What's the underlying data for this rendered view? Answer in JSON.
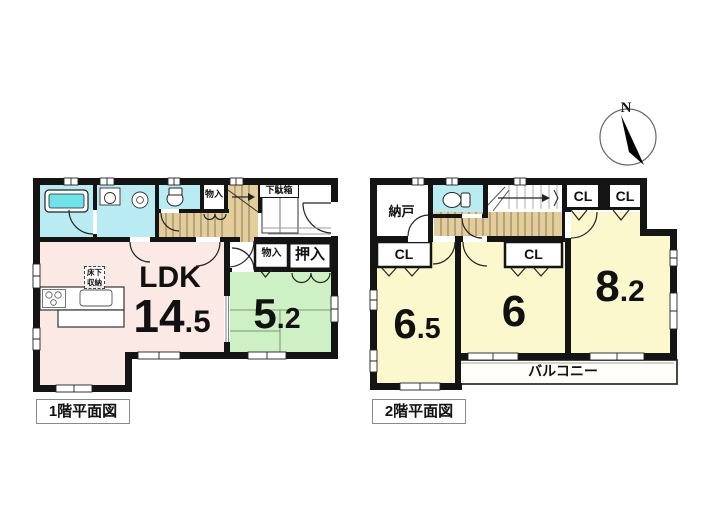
{
  "compass": {
    "north": "N"
  },
  "floor1": {
    "caption": "1階平面図",
    "ldk_label": "LDK",
    "ldk_area": "14.5",
    "tatami_area": "5.2",
    "storage_top": "物入",
    "storage_mid": "物入",
    "oshiire": "押入",
    "shoe_box": "下駄箱",
    "underfloor_storage": "床下収納"
  },
  "floor2": {
    "caption": "2階平面図",
    "storage_room": "納戸",
    "closets": [
      "CL",
      "CL",
      "CL",
      "CL"
    ],
    "room_a_area": "6.5",
    "room_b_area": "6",
    "room_c_area": "8.2",
    "balcony": "バルコニー"
  },
  "colors": {
    "wall": "#141414",
    "water_room": "#b9ecf2",
    "tub": "#6fe3ea",
    "ldk": "#fbe9e6",
    "tatami": "#cdf0c4",
    "bedroom": "#fbf8cd",
    "stairs": "#e2cd9b"
  }
}
